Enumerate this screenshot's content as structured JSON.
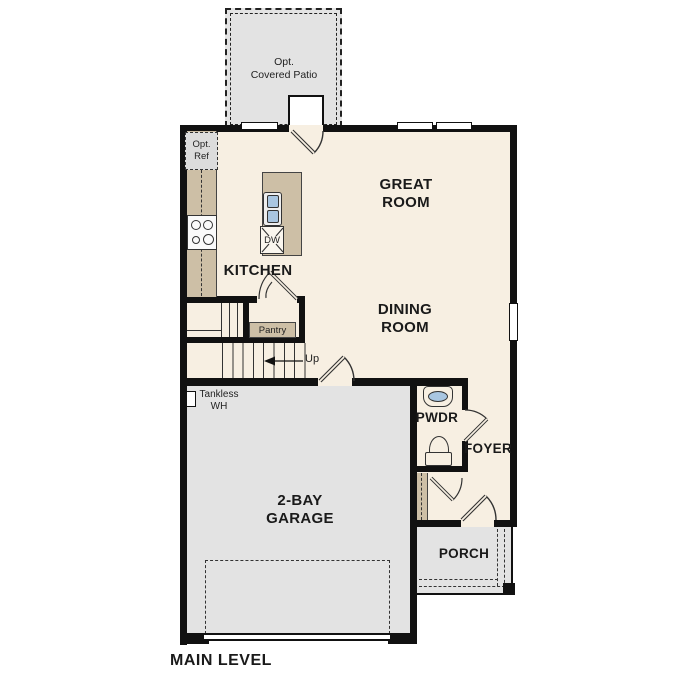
{
  "rooms": {
    "patio": {
      "label": "Opt.\nCovered Patio"
    },
    "great_room": {
      "label": "GREAT\nROOM"
    },
    "dining_room": {
      "label": "DINING\nROOM"
    },
    "kitchen": {
      "label": "KITCHEN",
      "opt_ref_label": "Opt.\nRef",
      "dishwasher_label": "DW"
    },
    "pantry": {
      "label": "Pantry"
    },
    "stairs": {
      "up_label": "Up"
    },
    "garage": {
      "label": "2-BAY\nGARAGE",
      "tankless_label": "Tankless\nWH"
    },
    "powder_room": {
      "label": "PWDR"
    },
    "foyer": {
      "label": "FOYER"
    },
    "porch": {
      "label": "PORCH"
    }
  },
  "footer": {
    "label": "MAIN LEVEL"
  },
  "colors": {
    "floor": "#f7efe2",
    "cabinetry": "#cdbfa6",
    "exterior_concrete": "#e3e3e3",
    "wall": "#111111",
    "fixture_water": "#a9c6e1"
  }
}
